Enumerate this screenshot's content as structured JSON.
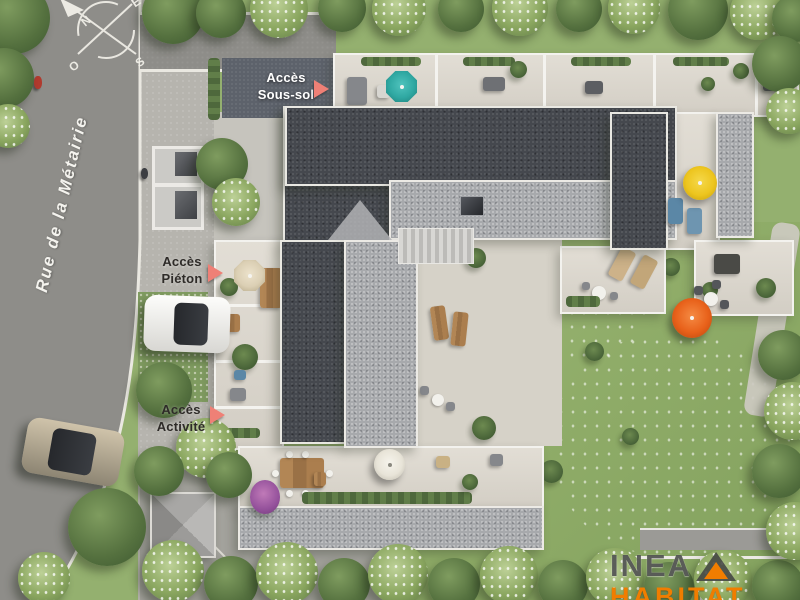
{
  "plan": {
    "street_name": "Rue de la Métairie",
    "compass": {
      "north": "N",
      "east": "E",
      "south": "S",
      "west": "O"
    },
    "access_points": [
      {
        "line1": "Accès",
        "line2": "Sous-sol"
      },
      {
        "line1": "Accès",
        "line2": "Piéton"
      },
      {
        "line1": "Accès",
        "line2": "Activité"
      }
    ],
    "logo": {
      "name": "INEA",
      "tagline": "HABITAT"
    },
    "colors": {
      "access_arrow": "#ef8076",
      "logo_orange": "#f07d00",
      "teal_parasol": "#2fa8a2",
      "yellow_parasol": "#edc51e",
      "orange_parasol": "#e8611a",
      "cream_parasol": "#dbcfb4",
      "lawn_green": "#94b06f",
      "road_gray": "#8e8d89",
      "roof_dark": "#45484e",
      "roof_light": "#a7a9ac"
    }
  }
}
